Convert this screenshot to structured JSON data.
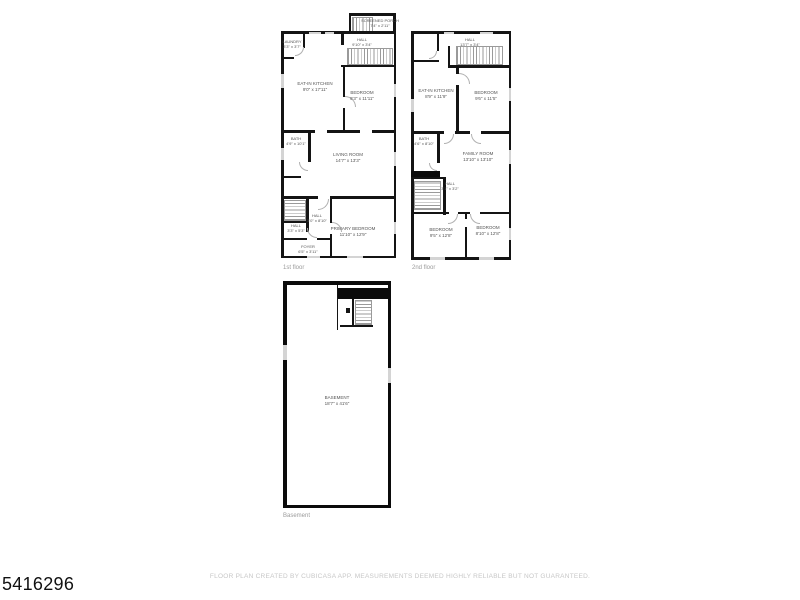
{
  "page": {
    "mls_number": "5416296",
    "footer": "FLOOR PLAN CREATED BY CUBICASA APP. MEASUREMENTS DEEMED HIGHLY RELIABLE BUT NOT GUARANTEED."
  },
  "colors": {
    "background": "#ffffff",
    "wall": "#141414",
    "window": "#d4d4d4",
    "room_label": "#555555",
    "caption": "#9b9b9b",
    "footer_text": "#c7c7c7"
  },
  "floors": [
    {
      "name": "1st floor",
      "rooms": [
        {
          "name": "SCREENED PORCH",
          "dims": "7'4\" x 2'11\""
        },
        {
          "name": "LAUNDRY",
          "dims": "3'3\" x 3'7\""
        },
        {
          "name": "HALL",
          "dims": "9'10\" x 3'4\""
        },
        {
          "name": "EAT-IN KITCHEN",
          "dims": "9'0\" x 17'11\""
        },
        {
          "name": "BEDROOM",
          "dims": "9'3\" x 11'11\""
        },
        {
          "name": "BATH",
          "dims": "4'9\" x 10'1\""
        },
        {
          "name": "LIVING ROOM",
          "dims": "14'7\" x 13'3\""
        },
        {
          "name": "HALL",
          "dims": "3'0\" x 8'10\""
        },
        {
          "name": "HALL",
          "dims": "3'3\" x 5'3\""
        },
        {
          "name": "PRIMARY BEDROOM",
          "dims": "11'10\" x 12'9\""
        },
        {
          "name": "FOYER",
          "dims": "6'5\" x 3'11\""
        }
      ]
    },
    {
      "name": "2nd floor",
      "rooms": [
        {
          "name": "HALL",
          "dims": "13'7\" x 3'4\""
        },
        {
          "name": "EAT-IN KITCHEN",
          "dims": "8'9\" x 11'9\""
        },
        {
          "name": "BEDROOM",
          "dims": "9'6\" x 11'5\""
        },
        {
          "name": "BATH",
          "dims": "4'6\" x 8'10\""
        },
        {
          "name": "FAMILY ROOM",
          "dims": "13'10\" x 13'10\""
        },
        {
          "name": "HALL",
          "dims": "3'1\" x 3'2\""
        },
        {
          "name": "BEDROOM",
          "dims": "9'5\" x 12'8\""
        },
        {
          "name": "BEDROOM",
          "dims": "8'10\" x 12'8\""
        }
      ]
    },
    {
      "name": "Basement",
      "rooms": [
        {
          "name": "BASEMENT",
          "dims": "18'7\" x 41'6\""
        }
      ]
    }
  ]
}
